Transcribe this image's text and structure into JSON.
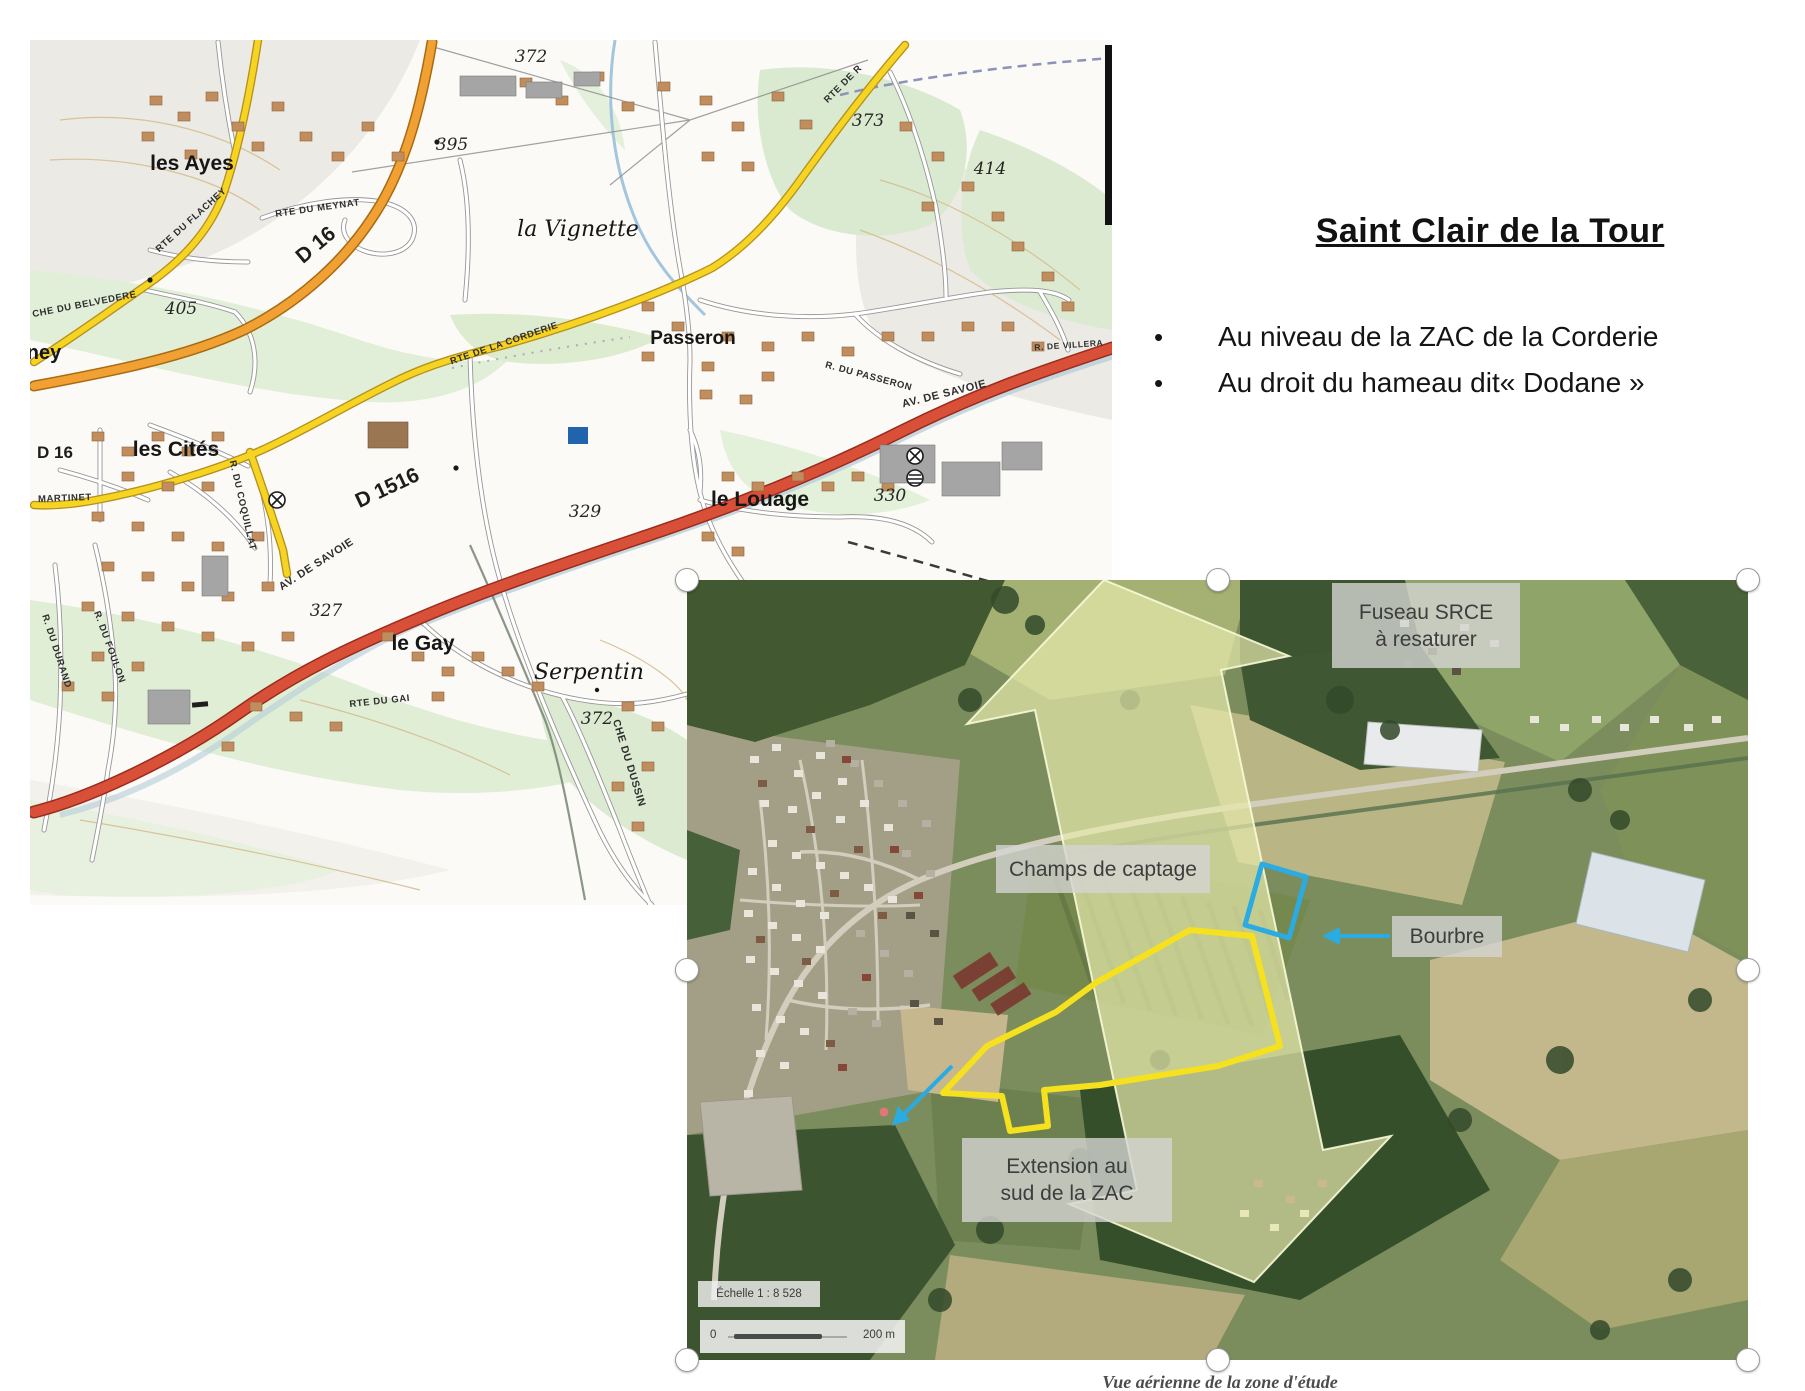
{
  "title": "Saint Clair de la Tour",
  "bullets": [
    "Au niveau de la ZAC de la Corderie",
    "Au droit du hameau dit« Dodane »"
  ],
  "topo_map": {
    "places": {
      "les_ayes": "les Ayes",
      "la_vignette": "la Vignette",
      "passeron": "Passeron",
      "les_cites": "les Cités",
      "le_louage": "le Louage",
      "le_gay": "le Gay",
      "serpentin": "Serpentin",
      "ney": "ney"
    },
    "roads": {
      "d16": "D 16",
      "d16_small": "D 16",
      "d1516": "D 1516",
      "flachey": "RTE DU FLACHEY",
      "meynat": "RTE DU MEYNAT",
      "belvedere": "CHE DU BELVEDERE",
      "corderie": "RTE DE LA CORDERIE",
      "rte_de_r": "RTE DE R",
      "passeron_r": "R. DU PASSERON",
      "villera": "R. DE VILLERA",
      "savoie_a": "AV. DE SAVOIE",
      "savoie_b": "AV. DE SAVOIE",
      "coquillat": "R. DU COQUILLAT",
      "martinet": "MARTINET",
      "gai": "RTE DU GAI",
      "dussin": "CHE DU DUSSIN",
      "foulon": "R. DU FOULON",
      "durand": "R. DU DURAND"
    },
    "elevations": {
      "e372_top": "372",
      "e395": "395",
      "e405": "405",
      "e373": "373",
      "e414": "414",
      "e329": "329",
      "e330": "330",
      "e327": "327",
      "e372_bottom": "372"
    }
  },
  "aerial": {
    "labels": {
      "fuseau_line1": "Fuseau SRCE",
      "fuseau_line2": "à resaturer",
      "champs": "Champs de captage",
      "bourbre": "Bourbre",
      "extension_line1": "Extension au",
      "extension_line2": "sud de la ZAC"
    },
    "scale_text": "Échelle 1 : 8 528",
    "scale_zero": "0",
    "scale_end": "200 m",
    "caption": "Vue aérienne de la zone d'étude",
    "colors": {
      "srce_arrow": "#e9ecb2",
      "zac_outline": "#f5e11e",
      "captage_outline": "#2aabe2",
      "annotation_arrow": "#2aabe2"
    }
  }
}
